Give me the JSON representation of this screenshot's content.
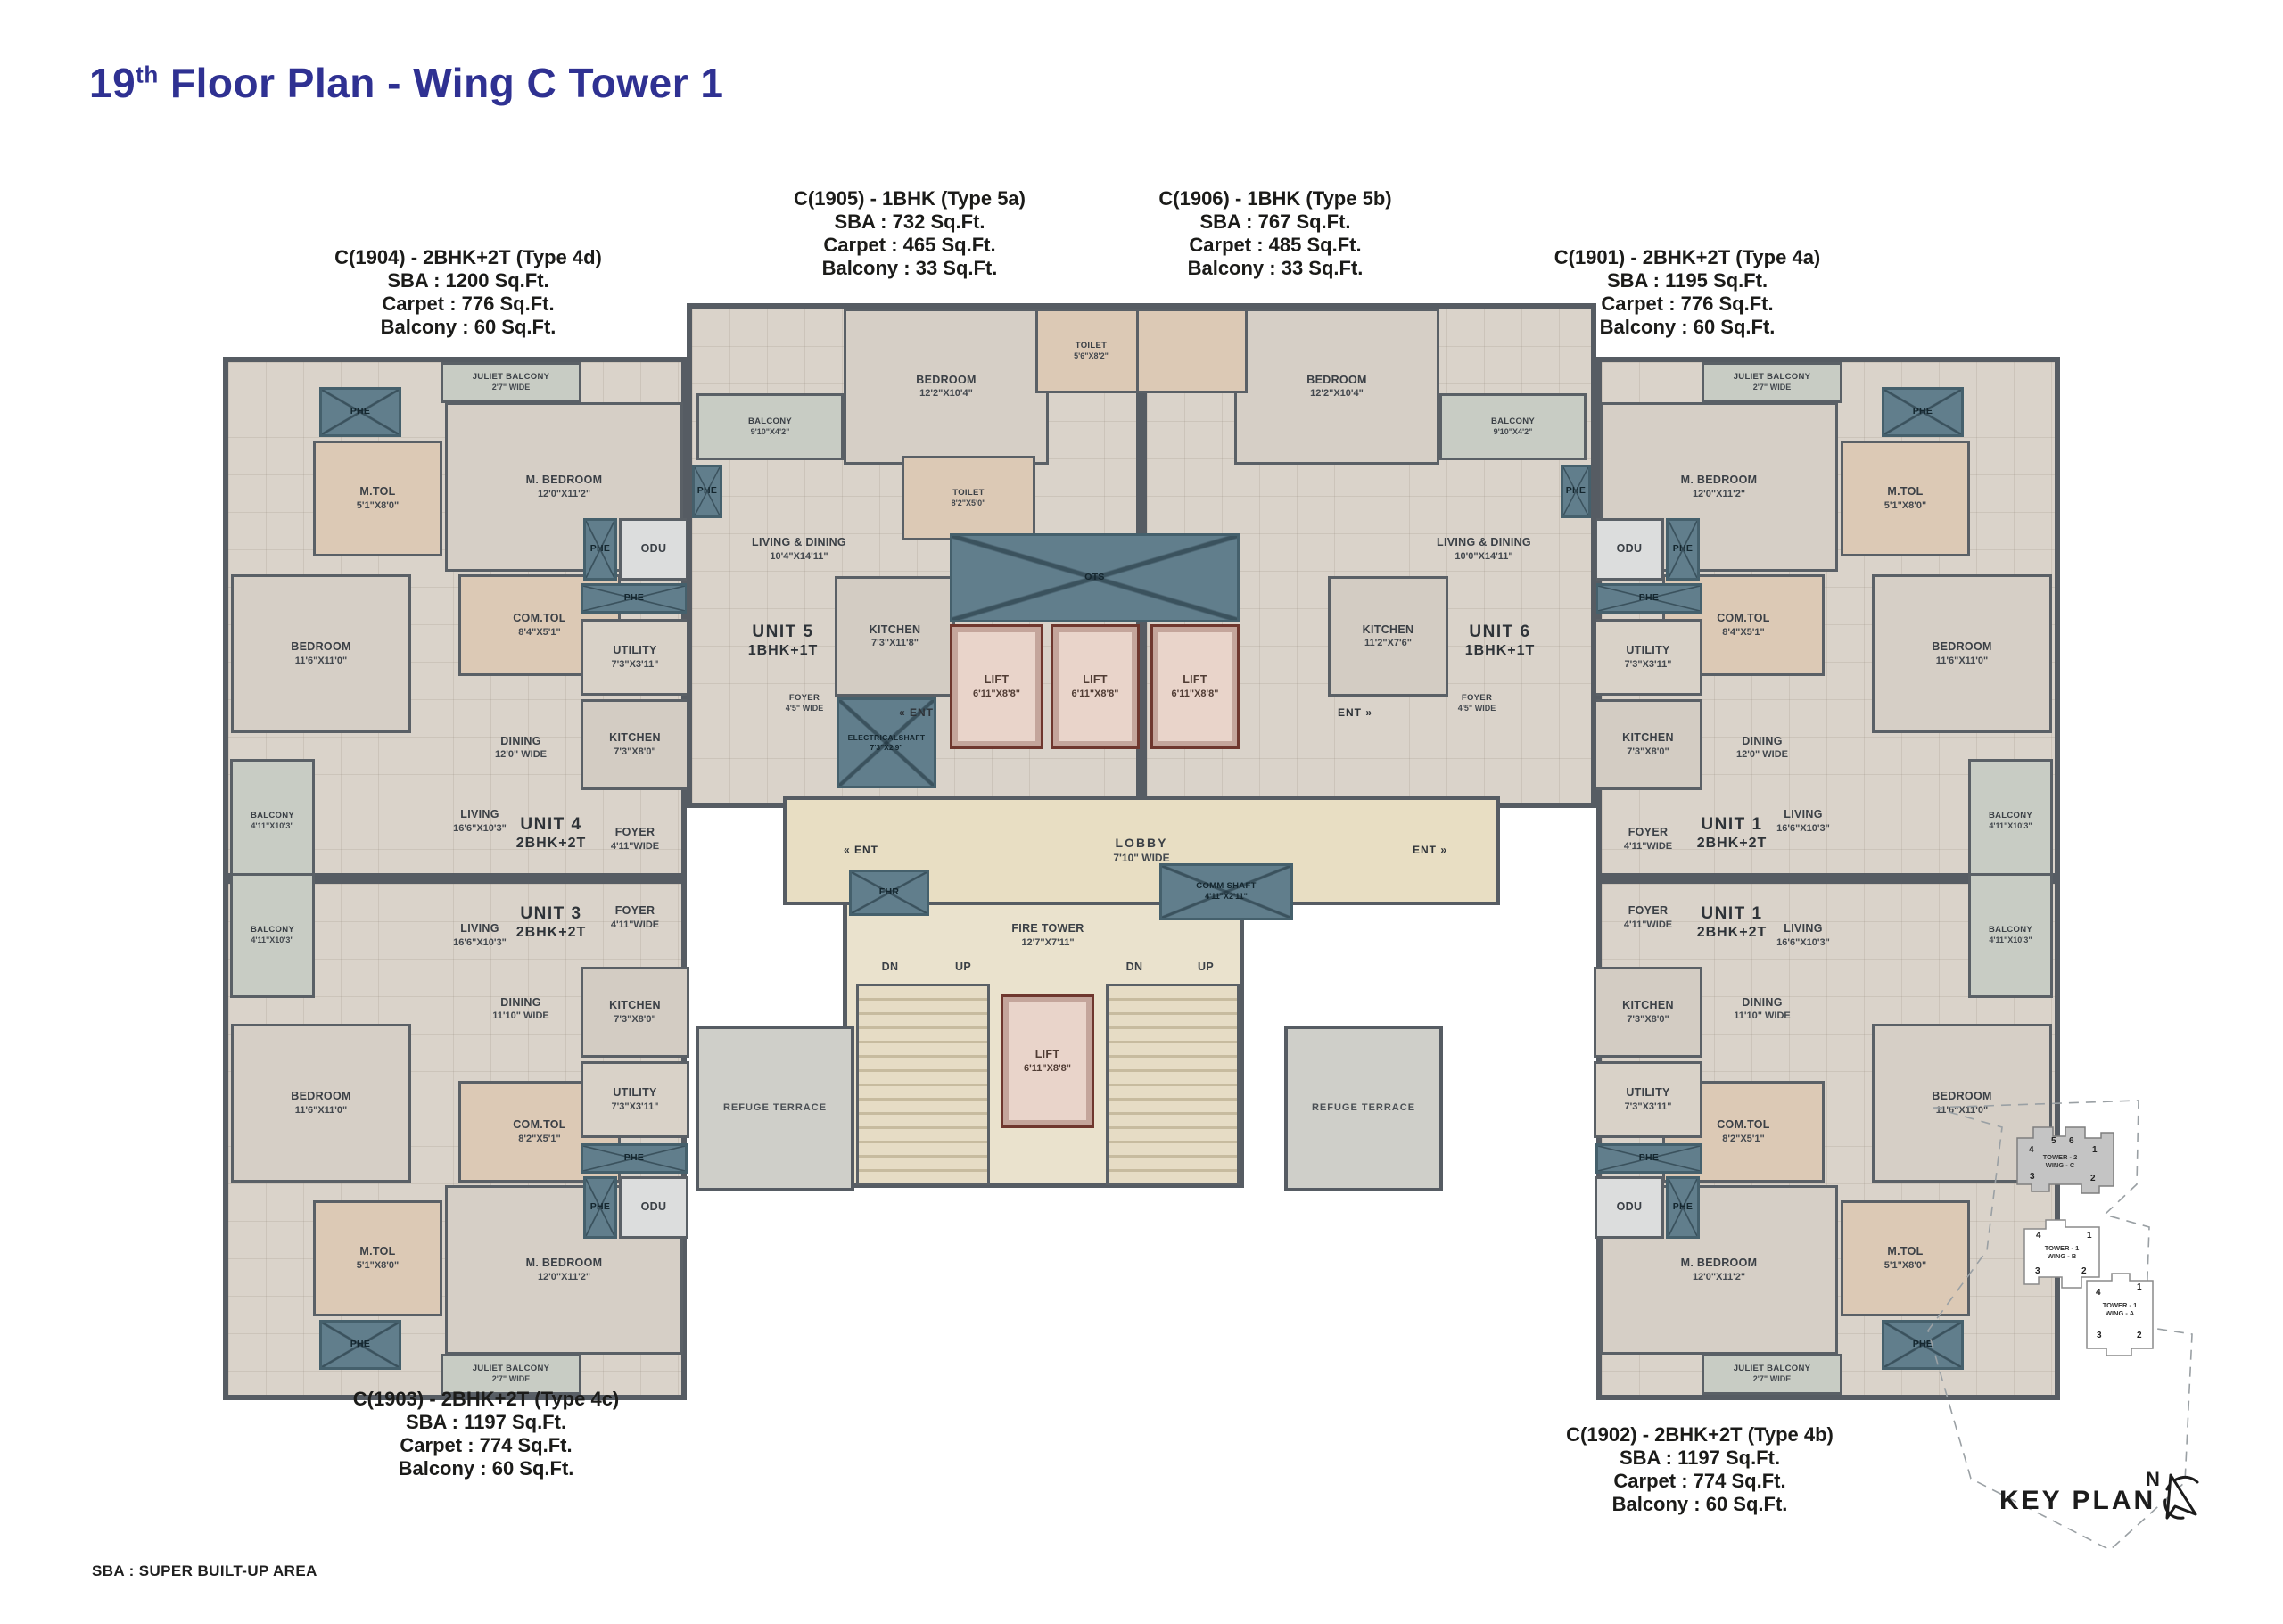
{
  "title": {
    "num": "19",
    "sup": "th",
    "rest": " Floor Plan - Wing C Tower 1"
  },
  "footnote": "SBA : SUPER BUILT-UP AREA",
  "annotations": {
    "c1904": {
      "name": "C(1904) - 2BHK+2T (Type 4d)",
      "sba": "SBA : 1200 Sq.Ft.",
      "carpet": "Carpet : 776 Sq.Ft.",
      "balcony": "Balcony : 60 Sq.Ft."
    },
    "c1905": {
      "name": "C(1905) - 1BHK (Type 5a)",
      "sba": "SBA : 732 Sq.Ft.",
      "carpet": "Carpet : 465 Sq.Ft.",
      "balcony": "Balcony : 33 Sq.Ft."
    },
    "c1906": {
      "name": "C(1906) - 1BHK (Type 5b)",
      "sba": "SBA : 767 Sq.Ft.",
      "carpet": "Carpet : 485 Sq.Ft.",
      "balcony": "Balcony : 33 Sq.Ft."
    },
    "c1901": {
      "name": "C(1901) - 2BHK+2T (Type 4a)",
      "sba": "SBA : 1195 Sq.Ft.",
      "carpet": "Carpet : 776 Sq.Ft.",
      "balcony": "Balcony : 60 Sq.Ft."
    },
    "c1903": {
      "name": "C(1903) - 2BHK+2T (Type 4c)",
      "sba": "SBA : 1197 Sq.Ft.",
      "carpet": "Carpet : 774 Sq.Ft.",
      "balcony": "Balcony : 60 Sq.Ft."
    },
    "c1902": {
      "name": "C(1902) - 2BHK+2T (Type 4b)",
      "sba": "SBA : 1197 Sq.Ft.",
      "carpet": "Carpet : 774 Sq.Ft.",
      "balcony": "Balcony : 60 Sq.Ft."
    }
  },
  "rooms": {
    "phe": "PHE",
    "odu": "ODU",
    "ots": "OTS",
    "fhr": "FHR",
    "ent_l": "« ENT",
    "ent_r": "ENT »",
    "dn": "DN",
    "up": "UP",
    "mtol": "M.TOL",
    "mtol_dims": "5'1\"X8'0\"",
    "mbed": "M. BEDROOM",
    "mbed_dims": "12'0\"X11'2\"",
    "bed": "BEDROOM",
    "bed_dims": "11'6\"X11'0\"",
    "bed_c": "BEDROOM",
    "bed_c_dims": "12'2\"X10'4\"",
    "comtol": "COM.TOL",
    "comtol_dims_a": "8'4\"X5'1\"",
    "comtol_dims_b": "8'2\"X5'1\"",
    "utility": "UTILITY",
    "utility_dims": "7'3\"X3'11\"",
    "kitchen": "KITCHEN",
    "kitchen_dims": "7'3\"X8'0\"",
    "kitchen5_dims": "7'3\"X11'8\"",
    "kitchen6_dims": "11'2\"X7'6\"",
    "dining": "DINING",
    "dining_dims_a": "12'0\" WIDE",
    "dining_dims_b": "11'10\" WIDE",
    "living": "LIVING",
    "living_dims": "16'6\"X10'3\"",
    "balcony": "BALCONY",
    "balcony_dims": "4'11\"X10'3\"",
    "balcony_c_dims": "9'10\"X4'2\"",
    "foyer": "FOYER",
    "foyer_dims": "4'11\"WIDE",
    "foyer_core_dims": "4'5\" WIDE",
    "juliet": "JULIET BALCONY",
    "juliet_dims": "2'7\" WIDE",
    "toilet": "TOILET",
    "toilet_dims_a": "5'6\"X8'2\"",
    "toilet_dims_b": "8'2\"X5'0\"",
    "ld": "LIVING & DINING",
    "ld_dims_a": "10'4\"X14'11\"",
    "ld_dims_b": "10'0\"X14'11\"",
    "lift": "LIFT",
    "lift_dims": "6'11\"X8'8\"",
    "lobby": "LOBBY",
    "lobby_dims": "7'10\" WIDE",
    "eshaft": "ELECTRICALSHAFT",
    "eshaft_dims": "7'3\"X2'9\"",
    "comm": "COMM SHAFT",
    "comm_dims": "4'11\"X2'11\"",
    "fire": "FIRE TOWER",
    "fire_dims": "12'7\"X7'11\"",
    "refuge": "REFUGE TERRACE",
    "unit4": "UNIT 4",
    "unit3": "UNIT 3",
    "unit1": "UNIT 1",
    "unit5": "UNIT 5",
    "unit6": "UNIT 6",
    "t2": "2BHK+2T",
    "t1": "1BHK+1T"
  },
  "key_plan": {
    "label": "KEY PLAN",
    "north": "N",
    "t2c": {
      "l1": "TOWER - 2",
      "l2": "WING - C"
    },
    "t1b": {
      "l1": "TOWER - 1",
      "l2": "WING - B"
    },
    "t1a": {
      "l1": "TOWER - 1",
      "l2": "WING - A"
    },
    "n1": "1",
    "n2": "2",
    "n3": "3",
    "n4": "4",
    "n5": "5",
    "n6": "6"
  },
  "colors": {
    "accent": "#2f3192",
    "wall": "#5a6066",
    "slate": "#617e8c"
  }
}
